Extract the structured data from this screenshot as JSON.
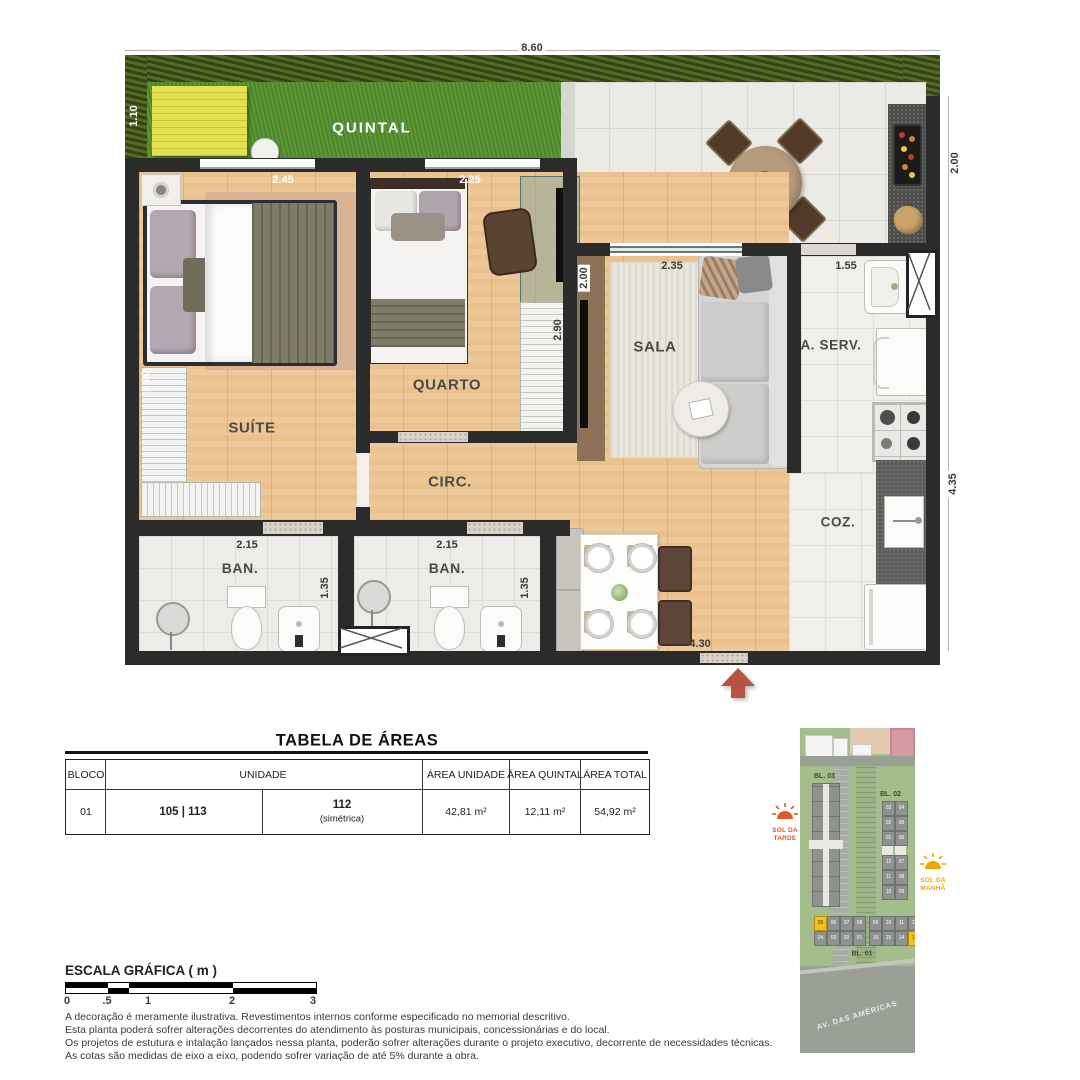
{
  "plan": {
    "labels": {
      "quintal": "QUINTAL",
      "suite": "SUÍTE",
      "quarto": "QUARTO",
      "sala": "SALA",
      "circ": "CIRC.",
      "ban_suite": "BAN.",
      "ban_social": "BAN.",
      "aserv": "A. SERV.",
      "coz": "COZ."
    },
    "dims": {
      "total_width": "8.60",
      "quintal_depth": "1.10",
      "patio_depth": "2.00",
      "suite_width": "2.45",
      "suite_depth": "3.90",
      "quarto_width": "2.25",
      "quarto_depth": "2.90",
      "sala_width": "2.35",
      "sala_tv_wall": "2.00",
      "aserv_width": "1.55",
      "right_depth": "4.35",
      "ban_suite_width": "2.15",
      "ban_suite_depth": "1.35",
      "ban_social_width": "2.15",
      "ban_social_depth": "1.35",
      "hall_width": "4.30"
    }
  },
  "areas_table": {
    "title": "TABELA DE ÁREAS",
    "headers": {
      "bloco": "BLOCO",
      "unidade": "UNIDADE",
      "area_unidade": "ÁREA UNIDADE",
      "area_quintal": "ÁREA QUINTAL",
      "area_total": "ÁREA TOTAL"
    },
    "row": {
      "bloco": "01",
      "unidades": "105 | 113",
      "simetrica_num": "112",
      "simetrica_note": "(simétrica)",
      "area_unidade": "42,81 m²",
      "area_quintal": "12,11 m²",
      "area_total": "54,92 m²"
    }
  },
  "scale_bar": {
    "title": "ESCALA GRÁFICA ( m )",
    "ticks": [
      "0",
      ".5",
      "1",
      "2",
      "3"
    ]
  },
  "disclaimers": [
    "A decoração é meramente ilustrativa. Revestimentos internos conforme especificado no memorial descritivo.",
    "Esta planta poderá sofrer alterações decorrentes do atendimento às posturas municipais, concessionárias e do local.",
    "Os projetos de estutura e intalação lançados nessa planta, poderão sofrer alterações durante o projeto executivo, decorrente de necessidades técnicas.",
    "As cotas são medidas de eixo a eixo, podendo sofrer variação de até 5% durante a obra."
  ],
  "sitemap": {
    "bl03": "BL. 03",
    "bl02": "BL. 02",
    "bl01": "BL. 01",
    "street": "AV. DAS AMÉRICAS",
    "sun_afternoon": "SOL DA TARDE",
    "sun_morning": "SOL DA MANHÃ",
    "bl01_top": [
      "05",
      "06",
      "07",
      "08",
      "09",
      "10",
      "11",
      "12"
    ],
    "bl01_bottom": [
      "04",
      "03",
      "02",
      "01",
      "16",
      "15",
      "14",
      "13"
    ],
    "bl02_left": [
      "03",
      "02",
      "01",
      "12",
      "11",
      "10"
    ],
    "bl02_right": [
      "04",
      "05",
      "06",
      "07",
      "08",
      "09"
    ]
  },
  "colors": {
    "entry_arrow": "#b65441",
    "unit_highlight": "#f2c21e",
    "sun_afternoon": "#e4572e",
    "sun_morning": "#f0a500",
    "grass": "#55912f",
    "wall": "#2b2b2b",
    "deck_yellow": "#e5e04e"
  }
}
